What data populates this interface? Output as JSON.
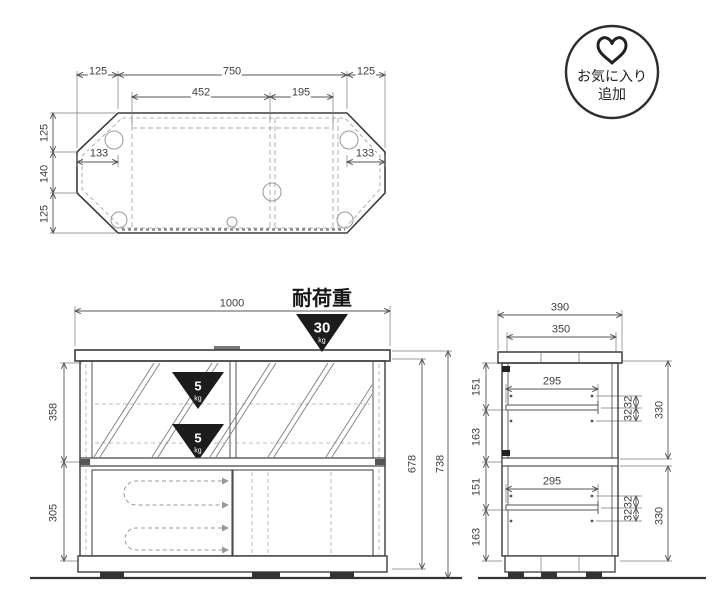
{
  "badge": {
    "line1": "お気に入り",
    "line2": "追加",
    "icon": "heart-icon"
  },
  "top_view": {
    "width_left": "125",
    "width_center": "750",
    "width_right": "125",
    "inner_left": "452",
    "inner_right": "195",
    "depth_top": "125",
    "depth_mid": "140",
    "depth_bottom": "125",
    "corner_left": "133",
    "corner_right": "133"
  },
  "front_view": {
    "width": "1000",
    "upper_height": "358",
    "lower_height": "305",
    "body_height": "678",
    "total_height": "738",
    "load": {
      "title": "耐荷重",
      "value": "30",
      "unit": "kg"
    },
    "shelf_load": {
      "value": "5",
      "unit": "kg"
    }
  },
  "side_view": {
    "depth": "390",
    "inner_depth": "350",
    "shelf_depth": "295",
    "seg_1": "151",
    "seg_2": "163",
    "seg_3": "151",
    "seg_4": "163",
    "pitch": "32",
    "opening": "330"
  },
  "colors": {
    "line": "#3d3d3d",
    "dashed": "#9a9a9a",
    "triangle": "#1c1c1c",
    "text": "#3f3f3f"
  }
}
